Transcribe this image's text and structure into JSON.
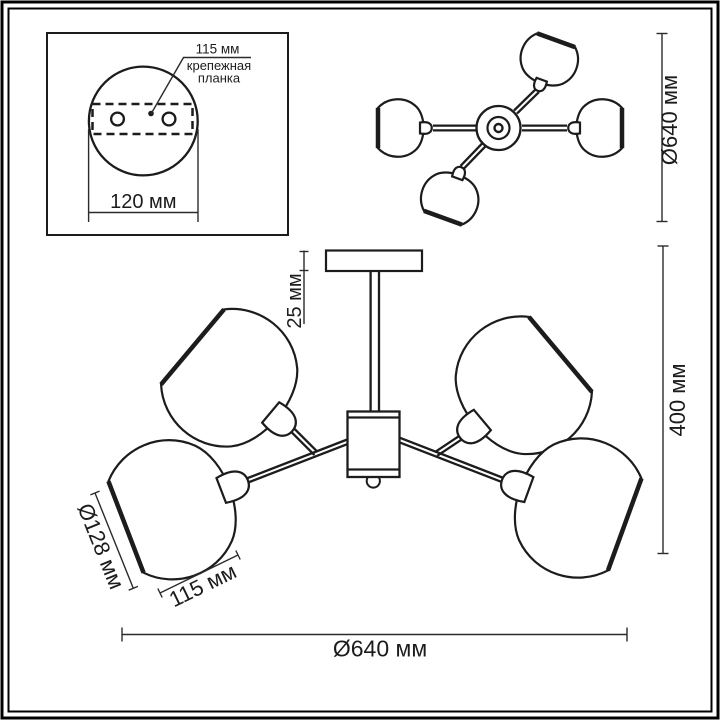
{
  "drawing": {
    "kind": "ceiling chandelier dimensional drawing",
    "units": "мм"
  },
  "labels": {
    "inset_hole_spacing": "115 мм",
    "inset_bracket_line1": "крепежная",
    "inset_bracket_line2": "планка",
    "inset_plate_width": "120 мм",
    "top_view_diameter": "Ø640 мм",
    "canopy_drop": "25 мм",
    "fixture_height": "400 мм",
    "shade_diameter": "Ø128 мм",
    "shade_width": "115 мм",
    "fixture_diameter": "Ø640 мм"
  },
  "dimensions_mm": {
    "mounting_hole_spacing": 115,
    "mounting_plate_width": 120,
    "canopy_drop": 25,
    "fixture_height": 400,
    "shade_diameter": 128,
    "shade_width": 115,
    "fixture_diameter": 640
  },
  "colors": {
    "line": "#1c1c1c",
    "dimension_line": "#2b2b2b",
    "background": "#ffffff"
  }
}
